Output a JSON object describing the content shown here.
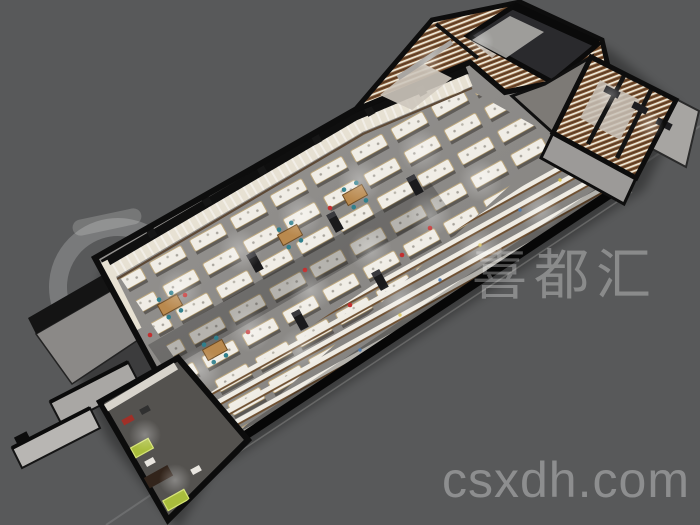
{
  "canvas": {
    "width": 700,
    "height": 525,
    "background_color": "#58595a"
  },
  "watermarks": {
    "brand_cn": "喜都汇",
    "site": "csxdh.com",
    "text_color": "rgba(255,255,255,0.30)",
    "logo_color": "rgba(255,255,255,0.20)"
  },
  "render_palette": {
    "wall_black": "#0d0d0d",
    "hall_floor": "#8a8885",
    "wall_shelving": "#e7e1d3",
    "shelf_wood": "#7b5130",
    "shelf_products": "#efe8d6",
    "counter_top": "#f3f0e9",
    "backroom_floor": "#cdc6bc",
    "gray_wall": "#9c9a98",
    "accent_wood": "#b9894e",
    "accent_teal": "#2f7f8c",
    "accent_green": "#a9bd3c",
    "accent_red": "#c23030"
  }
}
